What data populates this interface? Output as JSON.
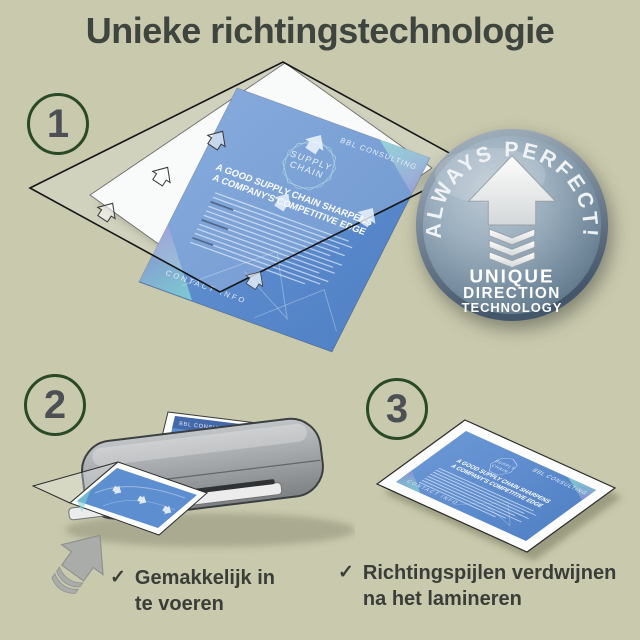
{
  "page": {
    "title": "Unieke richtingstechnologie"
  },
  "steps": {
    "one": "1",
    "two": "2",
    "three": "3"
  },
  "badge": {
    "arc_text": "ALWAYS PERFECT!",
    "line1": "UNIQUE",
    "line2": "DIRECTION",
    "line3": "TECHNOLOGY"
  },
  "document": {
    "brand": "BBL CONSULTING",
    "logo_line1": "SUPPLY",
    "logo_line2": "CHAIN",
    "heading_line1": "A GOOD SUPPLY CHAIN SHARPENS",
    "heading_line2": "A COMPANY'S COMPETITIVE EDGE",
    "footer": "CONTACT INFO"
  },
  "checklist": {
    "check_glyph": "✓",
    "item1_line1": "Gemakkelijk in",
    "item1_line2": "te voeren",
    "item2_line1": "Richtingspijlen verdwijnen",
    "item2_line2": "na het lamineren"
  },
  "colors": {
    "background": "#c9c9ad",
    "title_text": "#3e443e",
    "step_ring_green": "#2a4a27",
    "document_blue": "#5b8bcd",
    "badge_face": "#8fa3b3"
  }
}
